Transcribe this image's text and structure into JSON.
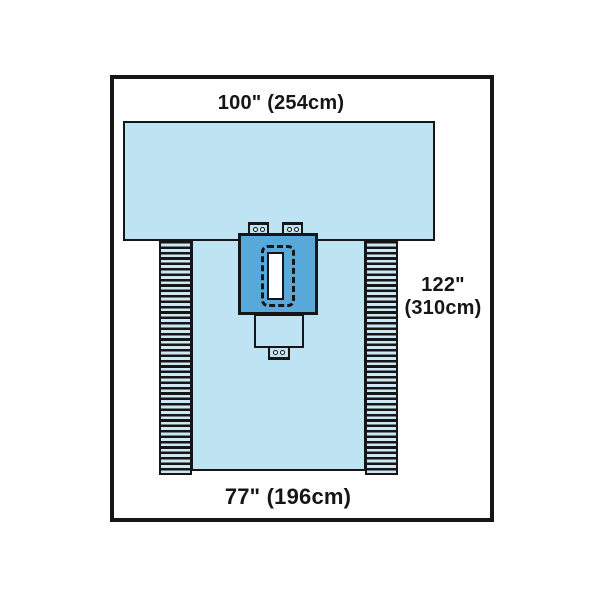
{
  "labels": {
    "top_width": "100\" (254cm)",
    "side_length_line1": "122\"",
    "side_length_line2": "(310cm)",
    "bottom_width": "77\" (196cm)"
  },
  "colors": {
    "drape_light_blue": "#bee4f4",
    "reinforcement_blue": "#58a9da",
    "line_black": "#161616",
    "fenestration_white": "#ffffff",
    "background_white": "#ffffff"
  }
}
